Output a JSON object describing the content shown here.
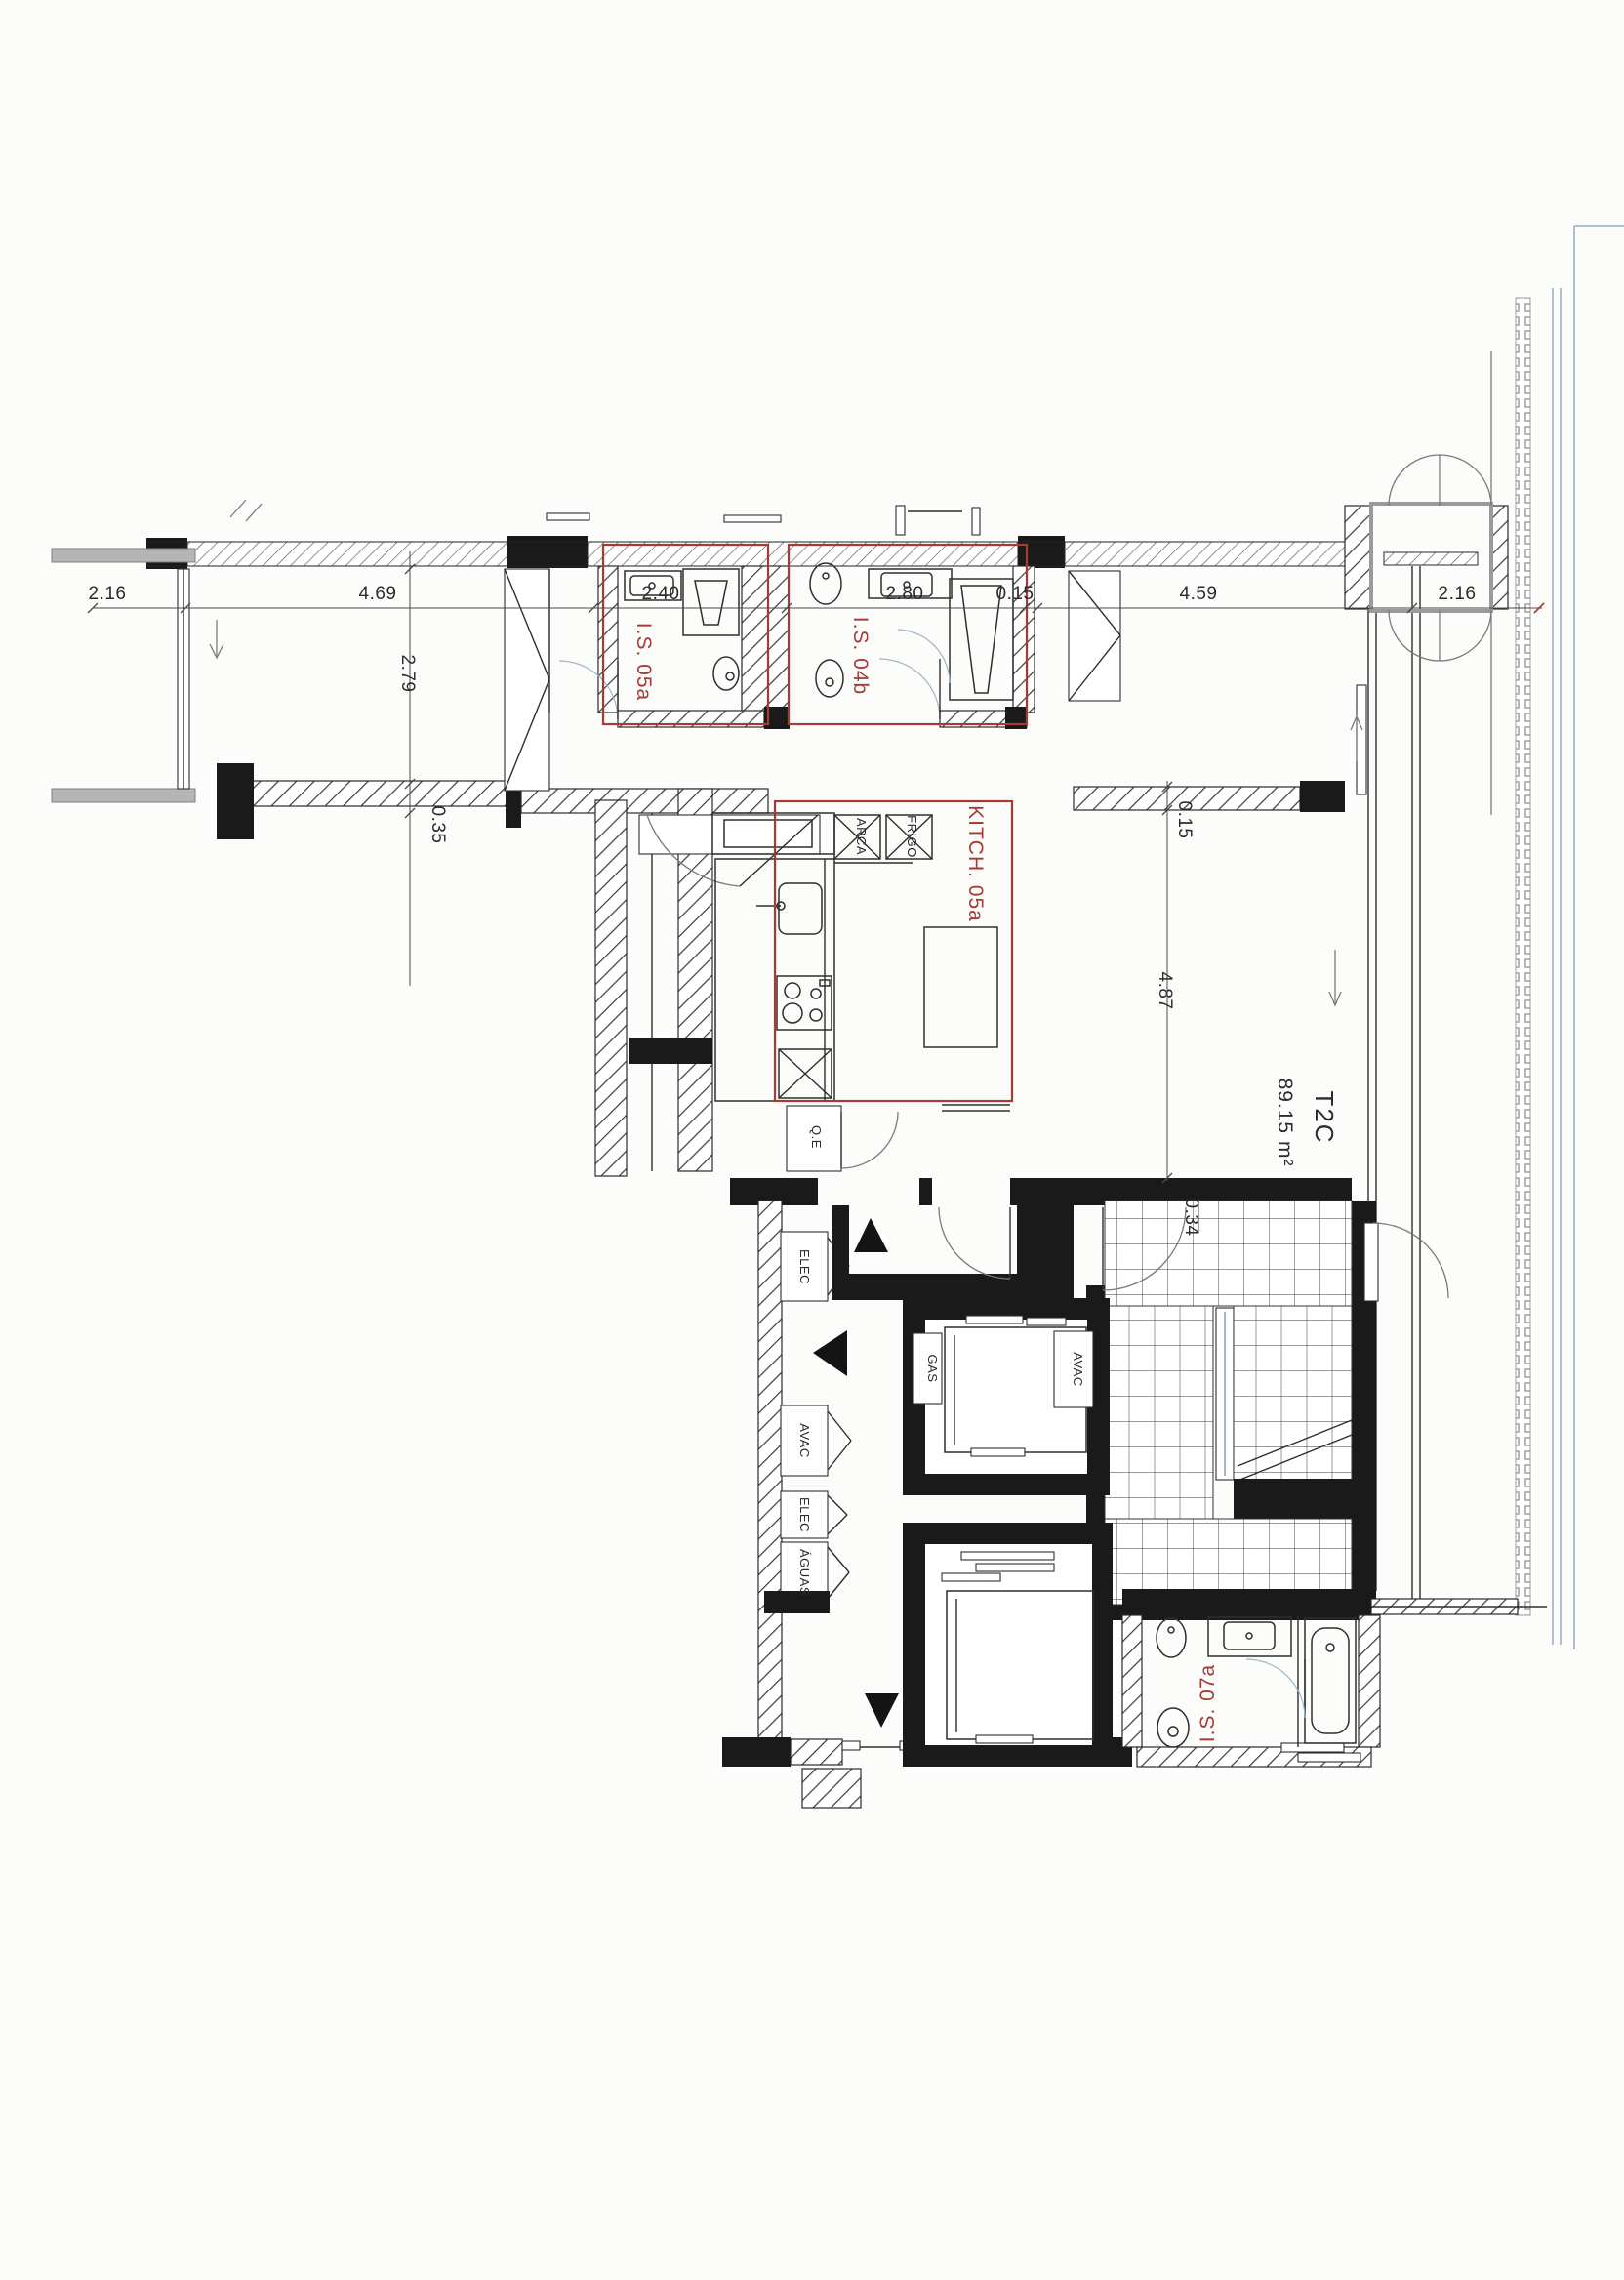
{
  "plan": {
    "unit": {
      "code": "T2C",
      "area": "89.15 m²"
    },
    "rooms": {
      "is05a": "I.S. 05a",
      "is04b": "I.S. 04b",
      "kitchen": "KITCH. 05a",
      "is07a": "I.S. 07a"
    },
    "closets": {
      "arca": "ARCA",
      "frigo": "FRIGO",
      "qe": "Q.E",
      "elec_upper": "ELEC",
      "gas": "GAS",
      "avac_right": "AVAC",
      "avac_left": "AVAC",
      "elec_lower": "ELEC",
      "aguas": "ÁGUAS"
    },
    "dimensions": {
      "top": [
        "2.16",
        "4.69",
        "2.40",
        "2.80",
        "0.15",
        "4.59",
        "2.16"
      ],
      "vertical": {
        "d279": "2.79",
        "d035": "0.35",
        "d015": "0.15",
        "d487": "4.87",
        "d034": "0.34"
      }
    },
    "colors": {
      "highlight_red": "#a63a35",
      "drawing_black": "#1a1a1a",
      "door_glass_blue": "#9fb6c9",
      "scan_gray": "#b5b5b5"
    }
  }
}
